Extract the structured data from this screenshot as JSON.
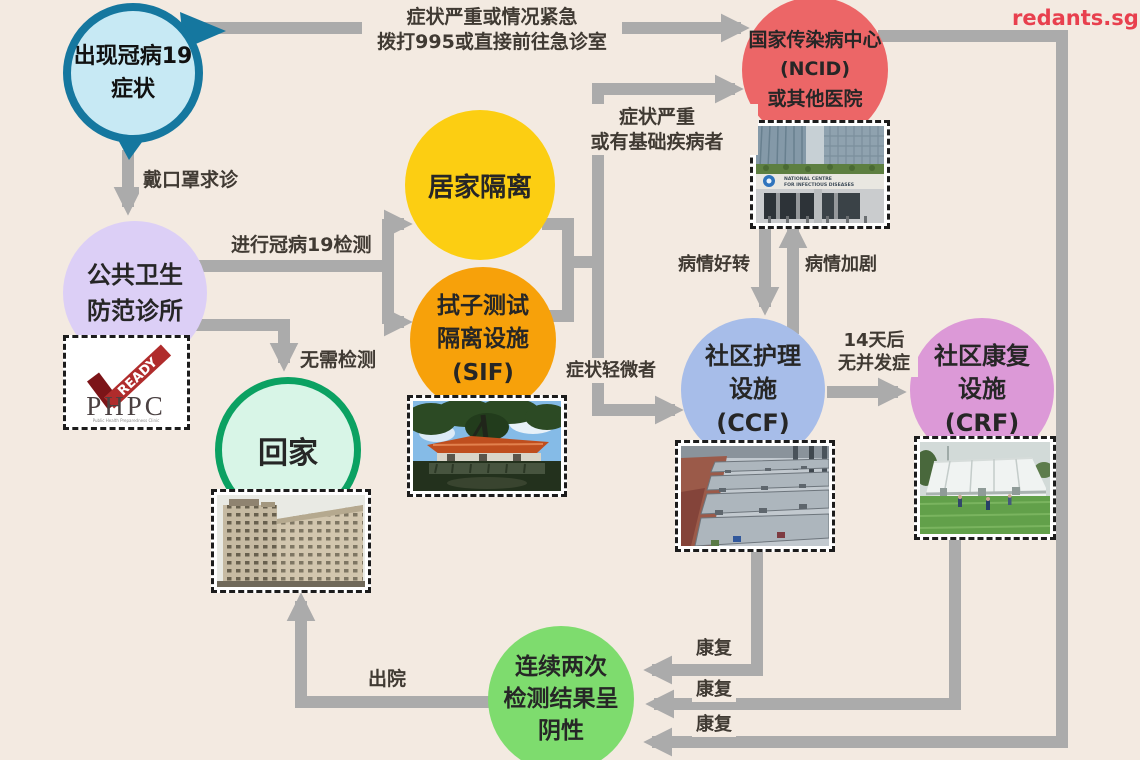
{
  "page": {
    "background_color": "#f3eae1",
    "arrow_color": "#ababab",
    "watermark": "redants.sg",
    "watermark_color": "#e8404e"
  },
  "nodes": {
    "symptom": {
      "label": "出现冠病19\n症状",
      "fill": "#c7e9f4",
      "border": "#15779f"
    },
    "phpc": {
      "label": "公共卫生\n防范诊所",
      "fill": "#dccff6"
    },
    "home_quarantine": {
      "label": "居家隔离",
      "fill": "#fcce12"
    },
    "sif": {
      "label": "拭子测试\n隔离设施\n(SIF)",
      "fill": "#f7a10a"
    },
    "go_home": {
      "label": "回家",
      "fill": "#d8f5e7",
      "border": "#0ba162"
    },
    "ncid": {
      "label": "国家传染病中心\n(NCID)\n或其他医院",
      "fill": "#ec6667"
    },
    "ccf": {
      "label": "社区护理\n设施\n(CCF)",
      "fill": "#a7bde9"
    },
    "crf": {
      "label": "社区康复\n设施\n(CRF)",
      "fill": "#dc99d7"
    },
    "negative_tests": {
      "label": "连续两次\n检测结果呈\n阴性",
      "fill": "#7edc6e"
    }
  },
  "edge_labels": {
    "emergency": "症状严重或情况紧急\n拨打995或直接前往急诊室",
    "mask": "戴口罩求诊",
    "covid_test": "进行冠病19检测",
    "no_test": "无需检测",
    "severe": "症状严重\n或有基础疾病者",
    "mild": "症状轻微者",
    "improving": "病情好转",
    "worsening": "病情加剧",
    "after_14_days": "14天后\n无并发症",
    "recovered_ccf": "康复",
    "recovered_crf": "康复",
    "recovered_ncid": "康复",
    "discharged": "出院"
  },
  "phpc_logo": {
    "ready": "READY",
    "name": "PHPC",
    "subtitle": "Public Health Preparedness Clinic"
  },
  "ncid_photo_sign": {
    "line1": "NATIONAL CENTRE",
    "line2": "FOR INFECTIOUS DISEASES"
  },
  "edges": [
    {
      "from": "symptom",
      "to": "ncid",
      "label": "emergency"
    },
    {
      "from": "symptom",
      "to": "phpc",
      "label": "mask"
    },
    {
      "from": "phpc",
      "to": "home_quarantine",
      "label": "covid_test"
    },
    {
      "from": "phpc",
      "to": "sif",
      "label": "covid_test"
    },
    {
      "from": "phpc",
      "to": "go_home",
      "label": "no_test"
    },
    {
      "from": "home_quarantine+sif",
      "to": "ncid",
      "label": "severe"
    },
    {
      "from": "home_quarantine+sif",
      "to": "ccf",
      "label": "mild"
    },
    {
      "from": "ncid",
      "to": "ccf",
      "label": "improving"
    },
    {
      "from": "ccf",
      "to": "ncid",
      "label": "worsening"
    },
    {
      "from": "ccf",
      "to": "crf",
      "label": "after_14_days"
    },
    {
      "from": "ccf",
      "to": "negative_tests",
      "label": "recovered_ccf"
    },
    {
      "from": "crf",
      "to": "negative_tests",
      "label": "recovered_crf"
    },
    {
      "from": "ncid",
      "to": "negative_tests",
      "label": "recovered_ncid"
    },
    {
      "from": "negative_tests",
      "to": "go_home",
      "label": "discharged"
    }
  ]
}
